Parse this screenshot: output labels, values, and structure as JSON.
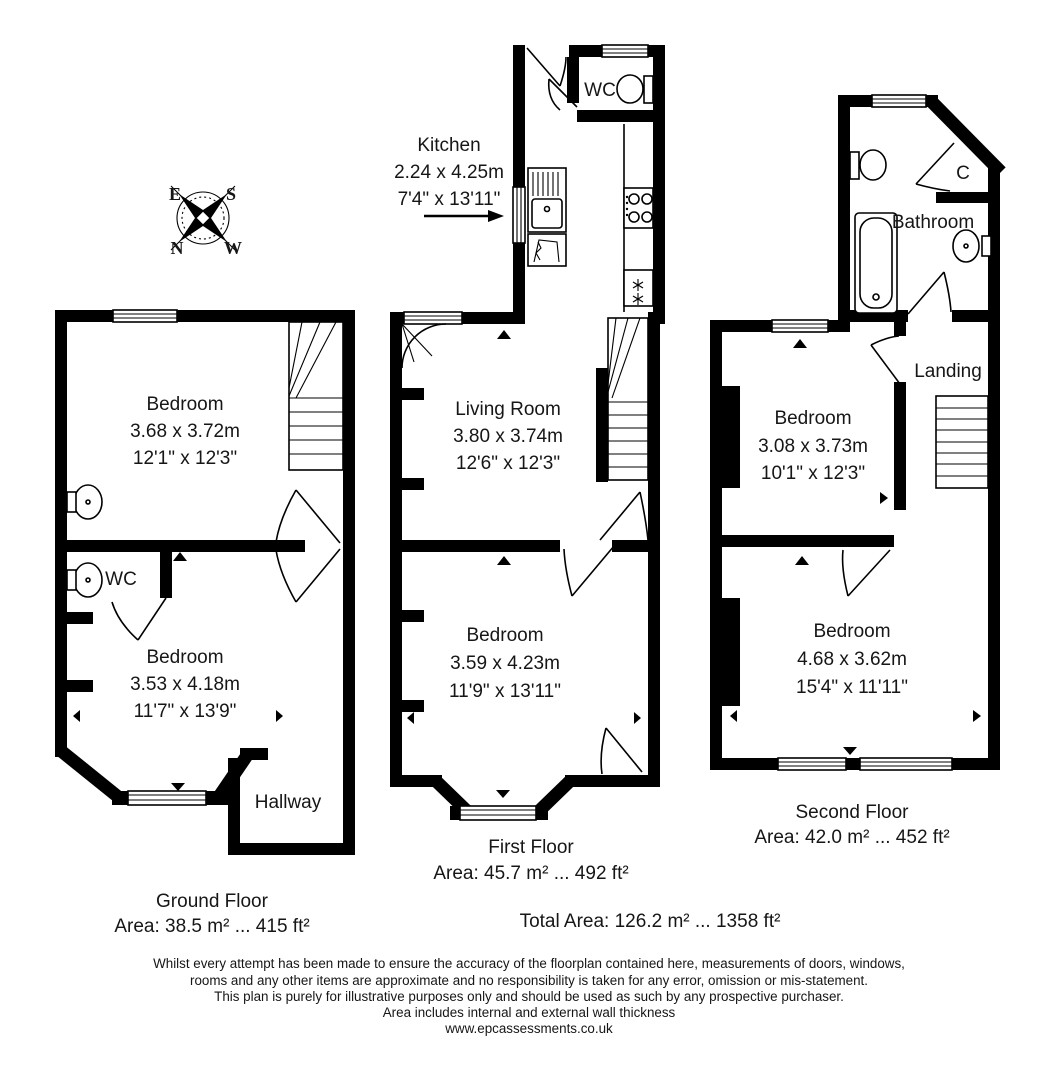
{
  "document": {
    "background_color": "#ffffff",
    "line_color": "#000000",
    "icons": {
      "compass": "rotated-compass-rose",
      "toilet": "cistern-and-bowl",
      "sink": "half-round-basin",
      "bath": "rounded-tub",
      "stove": "four-ring-hob",
      "fridge_freezer": "double-snowflake",
      "kitchen_pointer": "right-arrow"
    }
  },
  "compass": {
    "e": "E",
    "s": "S",
    "n": "N",
    "w": "W"
  },
  "ground_floor": {
    "title": "Ground Floor",
    "area": "Area: 38.5 m² ... 415 ft²",
    "bedroom1": {
      "name": "Bedroom",
      "metric": "3.68 x 3.72m",
      "imperial": "12'1\" x 12'3\""
    },
    "wc": {
      "name": "WC"
    },
    "bedroom2": {
      "name": "Bedroom",
      "metric": "3.53 x 4.18m",
      "imperial": "11'7\" x 13'9\""
    },
    "hallway": {
      "name": "Hallway"
    }
  },
  "first_floor": {
    "title": "First Floor",
    "area": "Area: 45.7 m² ... 492 ft²",
    "wc": {
      "name": "WC"
    },
    "kitchen": {
      "name": "Kitchen",
      "metric": "2.24 x 4.25m",
      "imperial": "7'4\" x 13'11\""
    },
    "living_room": {
      "name": "Living Room",
      "metric": "3.80 x 3.74m",
      "imperial": "12'6\" x 12'3\""
    },
    "bedroom": {
      "name": "Bedroom",
      "metric": "3.59 x 4.23m",
      "imperial": "11'9\" x 13'11\""
    }
  },
  "second_floor": {
    "title": "Second Floor",
    "area": "Area: 42.0 m² ... 452 ft²",
    "bathroom": {
      "name": "Bathroom"
    },
    "cupboard": {
      "name": "C"
    },
    "landing": {
      "name": "Landing"
    },
    "bedroom1": {
      "name": "Bedroom",
      "metric": "3.08 x 3.73m",
      "imperial": "10'1\" x 12'3\""
    },
    "bedroom2": {
      "name": "Bedroom",
      "metric": "4.68 x 3.62m",
      "imperial": "15'4\" x 11'11\""
    }
  },
  "totals": {
    "total_area": "Total Area: 126.2 m² ... 1358 ft²"
  },
  "disclaimer": {
    "line1": "Whilst every attempt has been made to ensure the accuracy of the floorplan contained here, measurements of doors, windows,",
    "line2": "rooms and any other items are approximate and no responsibility is taken for any error, omission or mis-statement.",
    "line3": "This plan is purely for illustrative purposes only and should be used as such by any prospective purchaser.",
    "line4": "Area includes internal and external wall thickness",
    "line5": "www.epcassessments.co.uk"
  }
}
